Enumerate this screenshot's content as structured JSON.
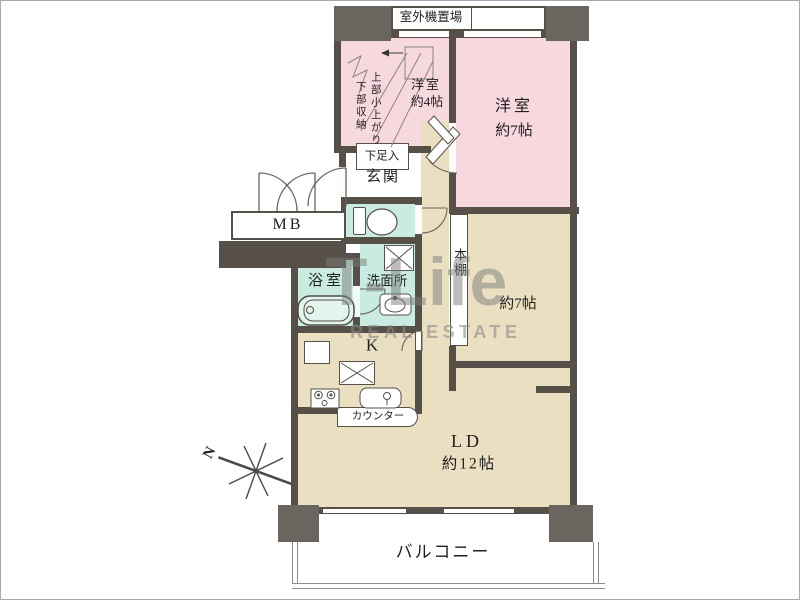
{
  "colors": {
    "wall": "#565049",
    "pillar": "#6a655f",
    "pink": "#f8d8df",
    "beige": "#ebdfc2",
    "mint": "#c9ebe1",
    "fence": "#8d8d8d",
    "text": "#1f1f1f",
    "watermark": "#7c7c7c"
  },
  "labels": {
    "outdoor_unit": "室外機置場",
    "western4_line1": "洋室",
    "western4_line2": "約4帖",
    "storage_note_line1": "上部小上がり",
    "storage_note_line2": "下部収納",
    "western7_line1": "洋室",
    "western7_line2": "約7帖",
    "shoe_cabinet": "下足入",
    "entrance": "玄関",
    "meter_box": "MB",
    "bathroom": "浴室",
    "washroom": "洗面所",
    "bookshelf": "本棚",
    "room7": "約7帖",
    "kitchen": "K",
    "counter": "カウンター",
    "living_line1": "LD",
    "living_line2": "約12帖",
    "balcony": "バルコニー",
    "north": "N"
  },
  "watermark": {
    "main": "T-Life",
    "sub": "REAL ESTATE"
  }
}
